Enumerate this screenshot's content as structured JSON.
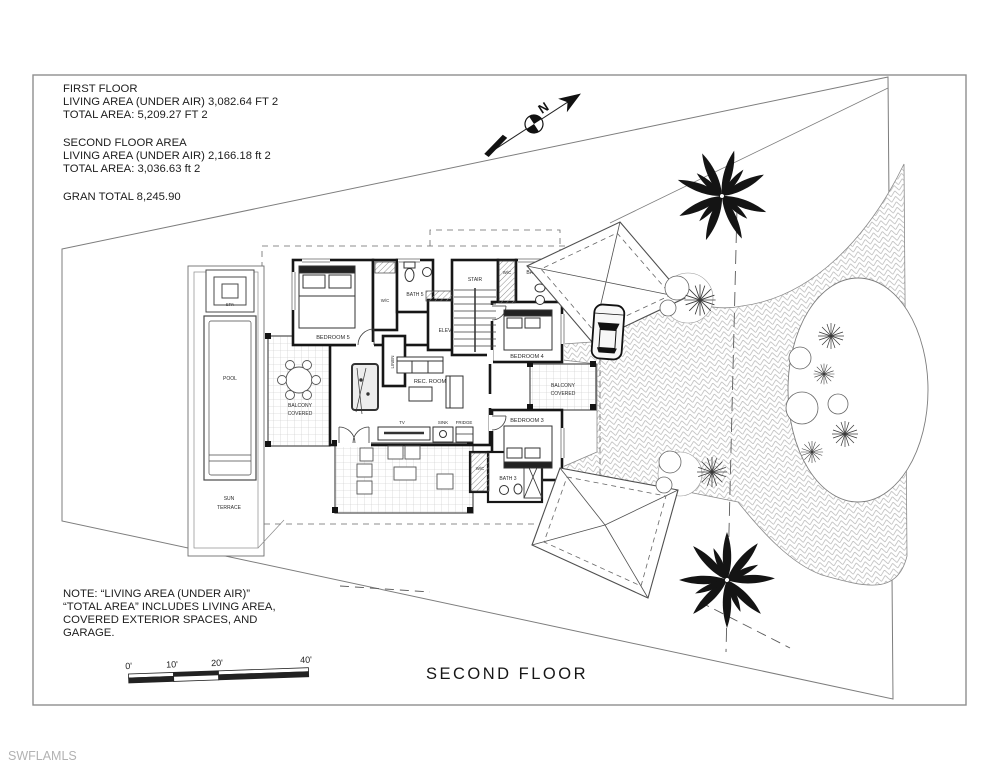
{
  "watermark": "SWFLAMLS",
  "title": "SECOND FLOOR",
  "north_label": "N",
  "area_summary": {
    "first_floor": {
      "heading": "FIRST FLOOR",
      "living": "LIVING AREA (UNDER AIR) 3,082.64 FT 2",
      "total": "TOTAL AREA:  5,209.27 FT 2"
    },
    "second_floor": {
      "heading": "SECOND FLOOR AREA",
      "living": "LIVING AREA (UNDER AIR) 2,166.18 ft 2",
      "total": "TOTAL AREA:  3,036.63 ft 2"
    },
    "grand_total": "GRAN TOTAL 8,245.90"
  },
  "note": {
    "line1": "NOTE: “LIVING AREA (UNDER AIR)”",
    "line2": "“TOTAL AREA” INCLUDES LIVING AREA,",
    "line3": "COVERED EXTERIOR SPACES, AND",
    "line4": "GARAGE."
  },
  "scale_bar": {
    "labels": [
      "0'",
      "10'",
      "20'",
      "40'"
    ]
  },
  "rooms": {
    "spa": "SPA",
    "pool": "POOL",
    "sun_terrace_1": "SUN",
    "sun_terrace_2": "TERRACE",
    "balcony_line1": "BALCONY",
    "balcony_line2": "COVERED",
    "bedroom5": "BEDROOM 5",
    "bedroom4": "BEDROOM 4",
    "bedroom3": "BEDROOM 3",
    "bath5": "BATH 5",
    "bath4": "BATH 4",
    "bath3": "BATH 3",
    "wc": "W/C",
    "linen": "LINEN",
    "elev": "ELEV",
    "stair": "STAIR",
    "rec_room": "REC. ROOM",
    "tv": "TV",
    "sink": "SINK",
    "fridge": "FRIDGE"
  }
}
